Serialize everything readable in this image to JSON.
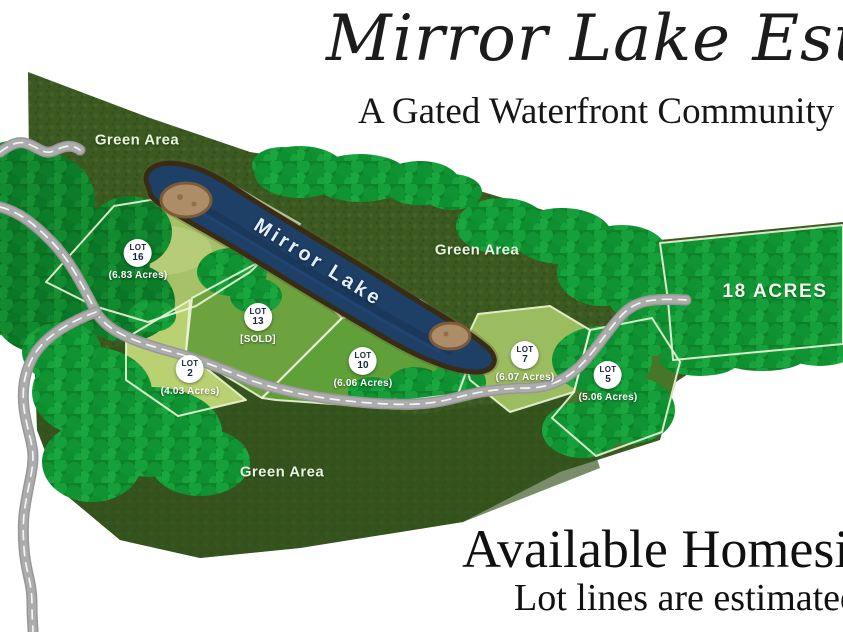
{
  "header": {
    "title": "Mirror Lake Estates",
    "subtitle": "A Gated Waterfront Community"
  },
  "map": {
    "lake_label": "Mirror Lake",
    "green_areas": [
      "Green Area",
      "Green Area",
      "Green Area"
    ],
    "large_parcel": {
      "label": "18 ACRES"
    },
    "lot_word": "LOT",
    "lots": [
      {
        "number": "16",
        "detail": "(6.83 Acres)"
      },
      {
        "number": "13",
        "detail": "[SOLD]"
      },
      {
        "number": "2",
        "detail": "(4.03 Acres)"
      },
      {
        "number": "10",
        "detail": "(6.06 Acres)"
      },
      {
        "number": "7",
        "detail": "(6.07 Acres)"
      },
      {
        "number": "5",
        "detail": "(5.06 Acres)"
      }
    ]
  },
  "footer": {
    "heading": "Available Homesites",
    "note": "Lot lines are estimated"
  },
  "colors": {
    "background": "#ffffff",
    "forest_dark": "#3b5920",
    "tree_green": "#129233",
    "lot_light_green": "#a6c167",
    "lake_blue": "#1e3f66",
    "shore_brown": "#372c15",
    "road_gray": "#acacac",
    "boundary_white": "#edf4d9",
    "badge_text_navy": "#17263f",
    "heading_black": "#1c1c1c"
  }
}
